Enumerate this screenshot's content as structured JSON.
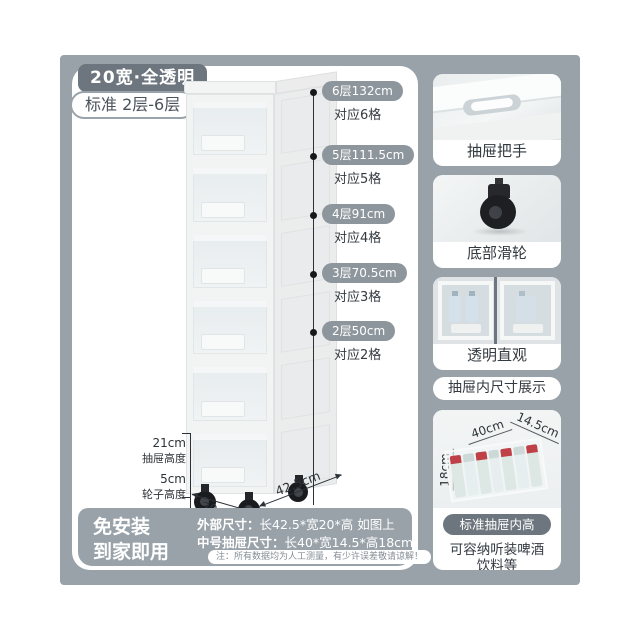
{
  "colors": {
    "background_gray": "#99a2a9",
    "dark_badge": "#6d767e",
    "marker_pill": "#8d969d",
    "text_dark": "#333a40"
  },
  "header": {
    "size_badge": "20宽·全透明",
    "layers_badge": "标准 2层-6层"
  },
  "height_markers": [
    {
      "label": "6层132cm",
      "note": "对应6格"
    },
    {
      "label": "5层111.5cm",
      "note": "对应5格"
    },
    {
      "label": "4层91cm",
      "note": "对应4格"
    },
    {
      "label": "3层70.5cm",
      "note": "对应3格"
    },
    {
      "label": "2层50cm",
      "note": "对应2格"
    }
  ],
  "side_measurements": {
    "drawer_height_value": "21cm",
    "drawer_height_label": "抽屉高度",
    "wheel_height_value": "5cm",
    "wheel_height_label": "轮子高度",
    "base_width": "20cm",
    "base_depth": "42.5cm"
  },
  "footer": {
    "slogan_line1": "免安装",
    "slogan_line2": "到家即用",
    "outer_dim_label": "外部尺寸：",
    "outer_dim_value": "长42.5*宽20*高 如图上",
    "drawer_dim_label": "中号抽屉尺寸：",
    "drawer_dim_value": "长40*宽14.5*高18cm",
    "note": "注：所有数据均为人工测量，有少许误差敬请谅解！"
  },
  "sidebar": {
    "features": [
      {
        "caption": "抽屉把手"
      },
      {
        "caption": "底部滑轮"
      },
      {
        "caption": "透明直观"
      }
    ],
    "section_title": "抽屉内尺寸展示",
    "inner_dims": {
      "length": "40cm",
      "width": "14.5cm",
      "height": "18cm"
    },
    "inner_height_badge": "标准抽屉内高18cm",
    "capacity_line1": "可容纳听装啤酒",
    "capacity_line2": "饮料等"
  }
}
